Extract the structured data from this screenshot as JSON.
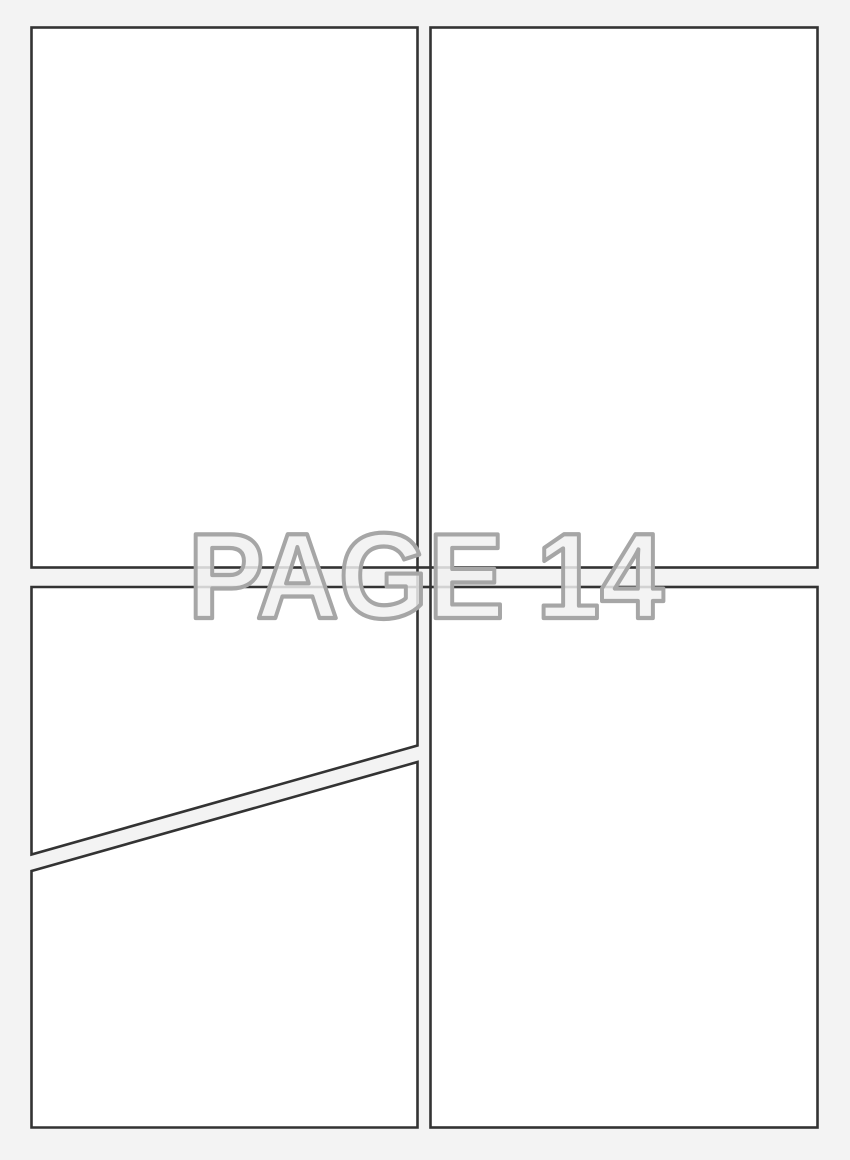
{
  "theme": {
    "page_bg": "#f3f3f3",
    "panel_fill": "#ffffff",
    "panel_border": "#333333",
    "label_fill": "#f1f1f1",
    "label_outline": "#a6a6a6"
  },
  "page": {
    "watermark_label": "PAGE 14"
  }
}
